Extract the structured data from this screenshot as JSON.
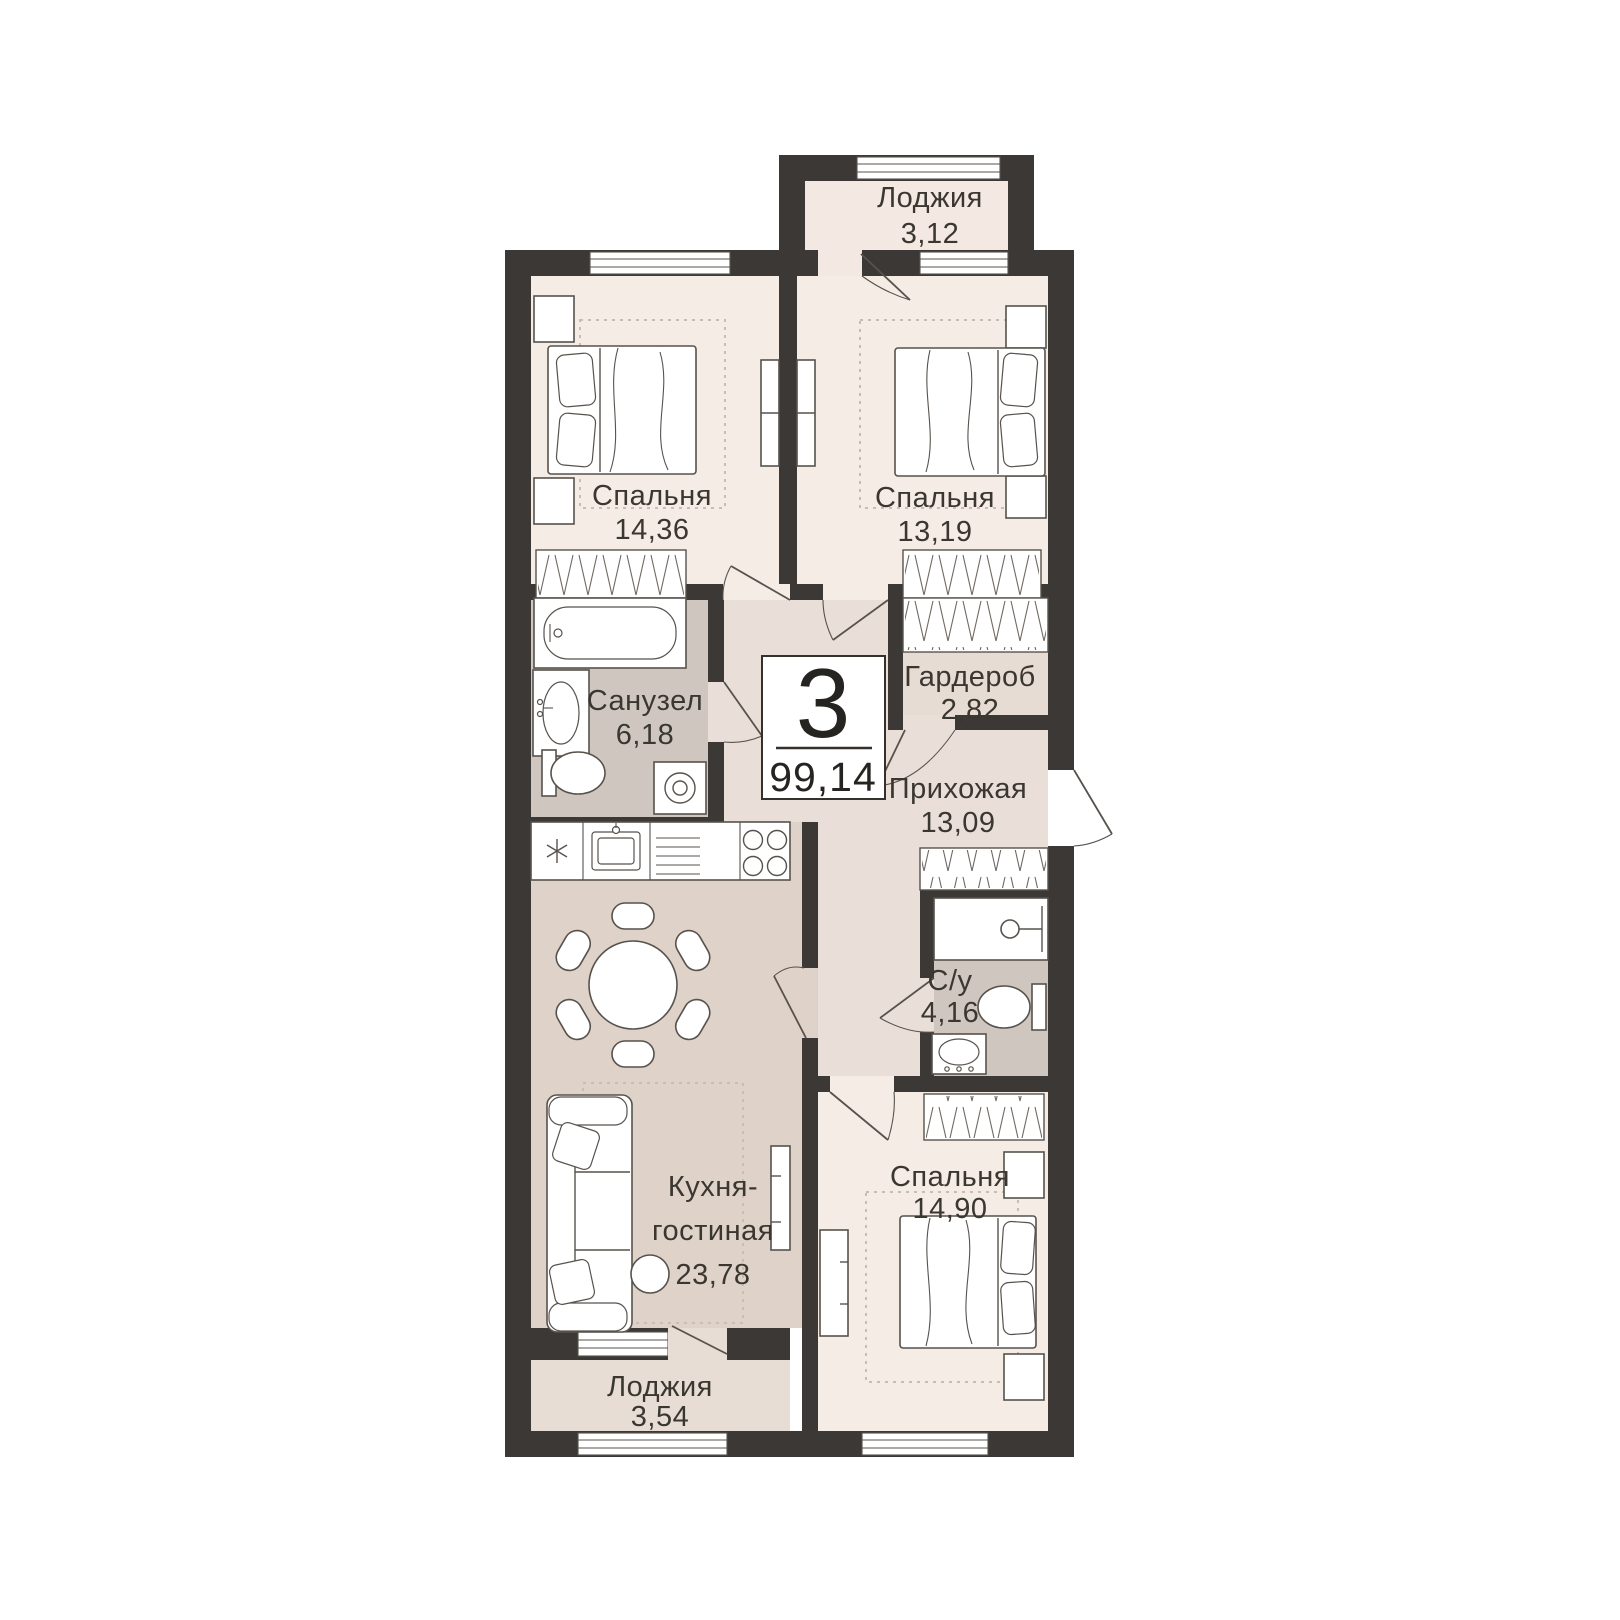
{
  "badge": {
    "rooms_count": "3",
    "total_area": "99,14"
  },
  "rooms": [
    {
      "id": "loggia-top",
      "name": "Лоджия",
      "area": "3,12"
    },
    {
      "id": "bedroom-1",
      "name": "Спальня",
      "area": "14,36"
    },
    {
      "id": "bedroom-2",
      "name": "Спальня",
      "area": "13,19"
    },
    {
      "id": "bathroom",
      "name": "Санузел",
      "area": "6,18"
    },
    {
      "id": "wardrobe-room",
      "name": "Гардероб",
      "area": "2,82"
    },
    {
      "id": "hallway",
      "name": "Прихожая",
      "area": "13,09"
    },
    {
      "id": "wc",
      "name": "С/у",
      "area": "4,16"
    },
    {
      "id": "kitchen-living",
      "name_line1": "Кухня-",
      "name_line2": "гостиная",
      "area": "23,78"
    },
    {
      "id": "bedroom-3",
      "name": "Спальня",
      "area": "14,90"
    },
    {
      "id": "loggia-bottom",
      "name": "Лоджия",
      "area": "3,54"
    }
  ],
  "colors": {
    "background": "#ffffff",
    "wall": "#3b3835",
    "bedroom_floor": "#f6ece6",
    "loggia_top_floor": "#f3e8e2",
    "loggia_bottom_floor": "#e8ddd5",
    "hall_floor": "#eadfd8",
    "wardrobe_floor": "#e7dcd4",
    "kitchen_floor": "#ded2c9",
    "bathroom_floor": "#cfc6bf",
    "furniture_stroke": "#57524c",
    "carpet_dash": "#c8bdb4",
    "label_text": "#3a3731",
    "badge_border": "#34312d"
  }
}
